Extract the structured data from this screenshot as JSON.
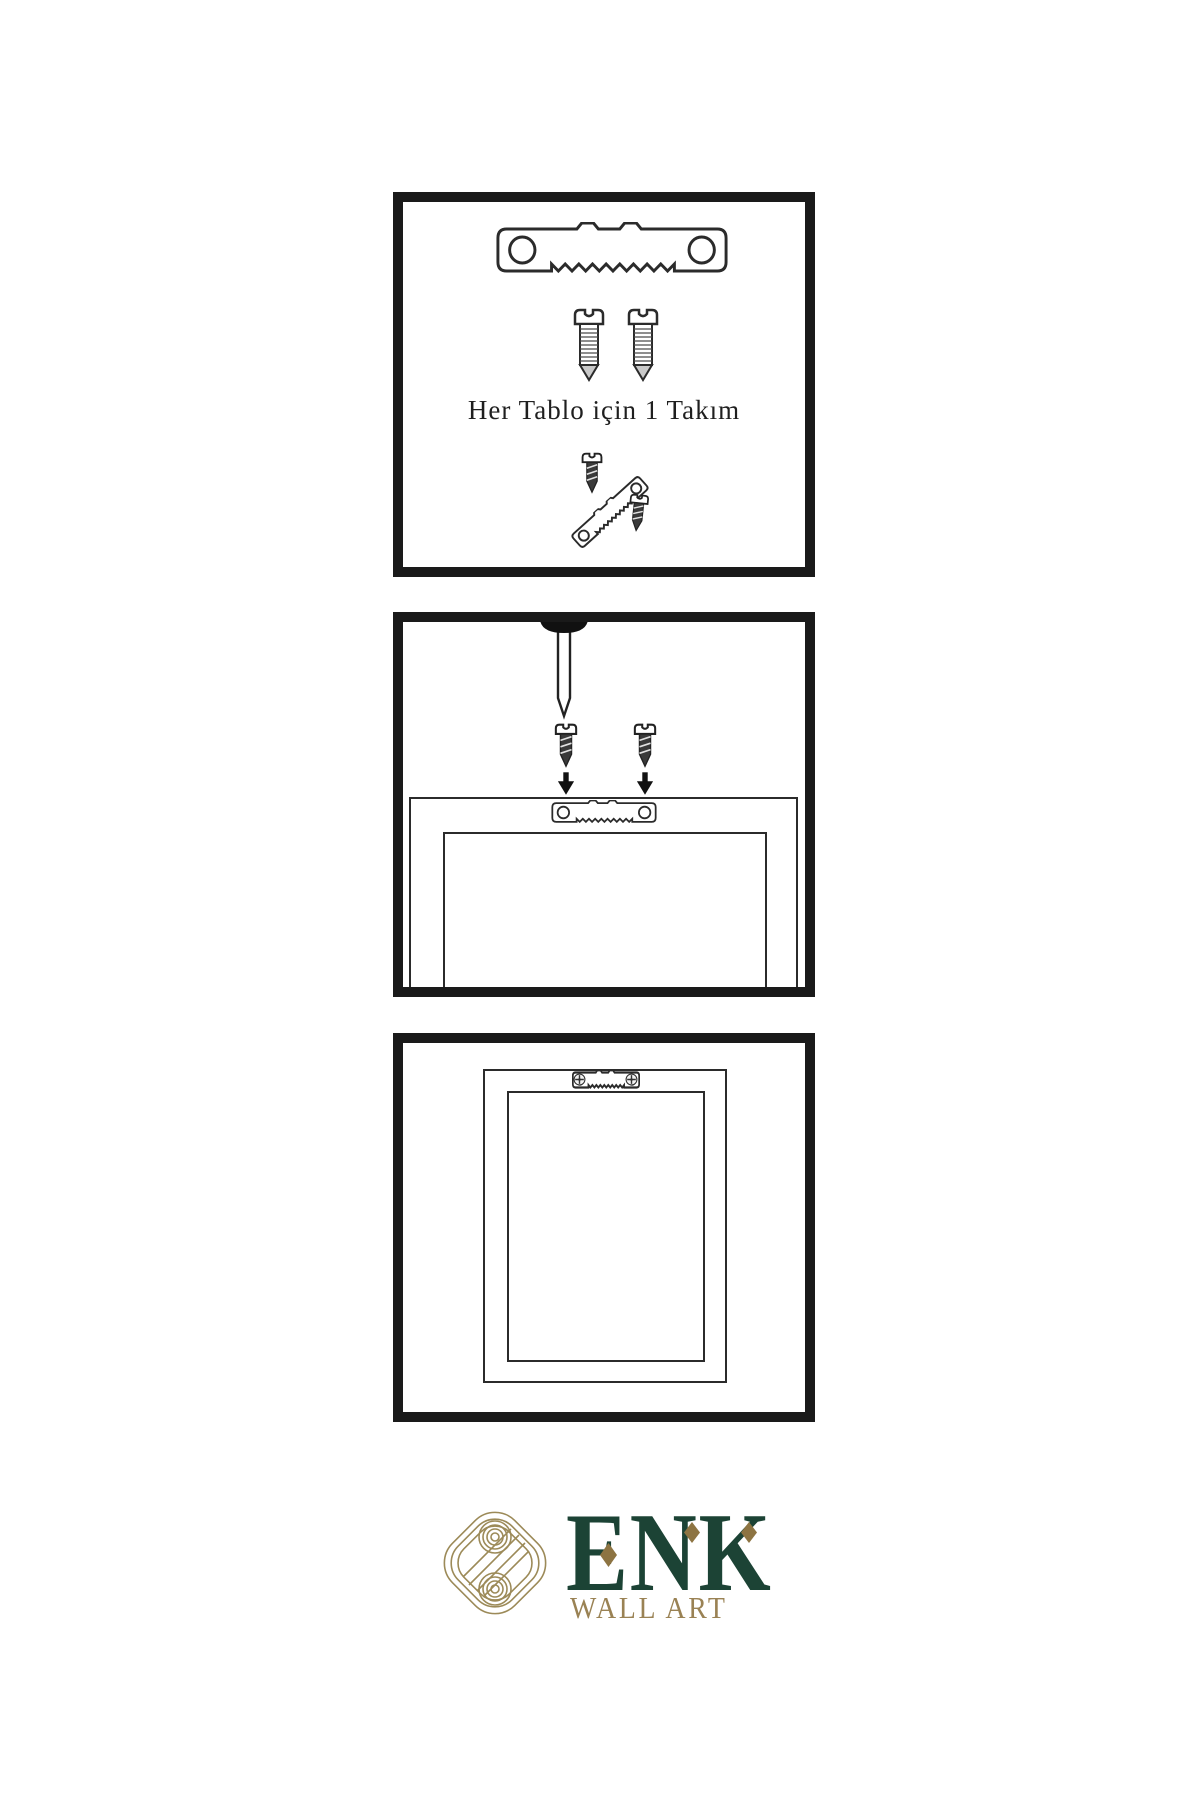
{
  "page": {
    "background": "#ffffff"
  },
  "panels": {
    "kit": {
      "caption": "Her Tablo için 1 Takım",
      "contents": [
        "sawtooth-hanger",
        "screw",
        "screw",
        "hanger-assembly"
      ]
    },
    "install": {
      "contents": [
        "wall-nail",
        "screw",
        "screw",
        "down-arrows",
        "frame-back-with-hanger"
      ]
    },
    "hang": {
      "contents": [
        "frame-back-hanging",
        "installed-sawtooth-hanger"
      ]
    }
  },
  "logo": {
    "brand": "ENK",
    "subtitle": "WALL ART"
  },
  "colors": {
    "brand_green": "#1c4335",
    "brand_gold": "#9a8254",
    "accent_gold": "#8d7442",
    "line": "#2b2b2b",
    "panel_border": "#1a1a1a"
  },
  "icons": {
    "sawtooth-hanger": "metal sawtooth picture hanger bar with two holes",
    "screw-light": "outlined threaded screw",
    "screw-dark": "dark filled screw",
    "nail": "wall nail with round black head",
    "arrow-down": "solid black downward arrow",
    "phillips-head": "installed screw head with cross slot",
    "brand-knot": "interlaced gold knot logo mark"
  }
}
